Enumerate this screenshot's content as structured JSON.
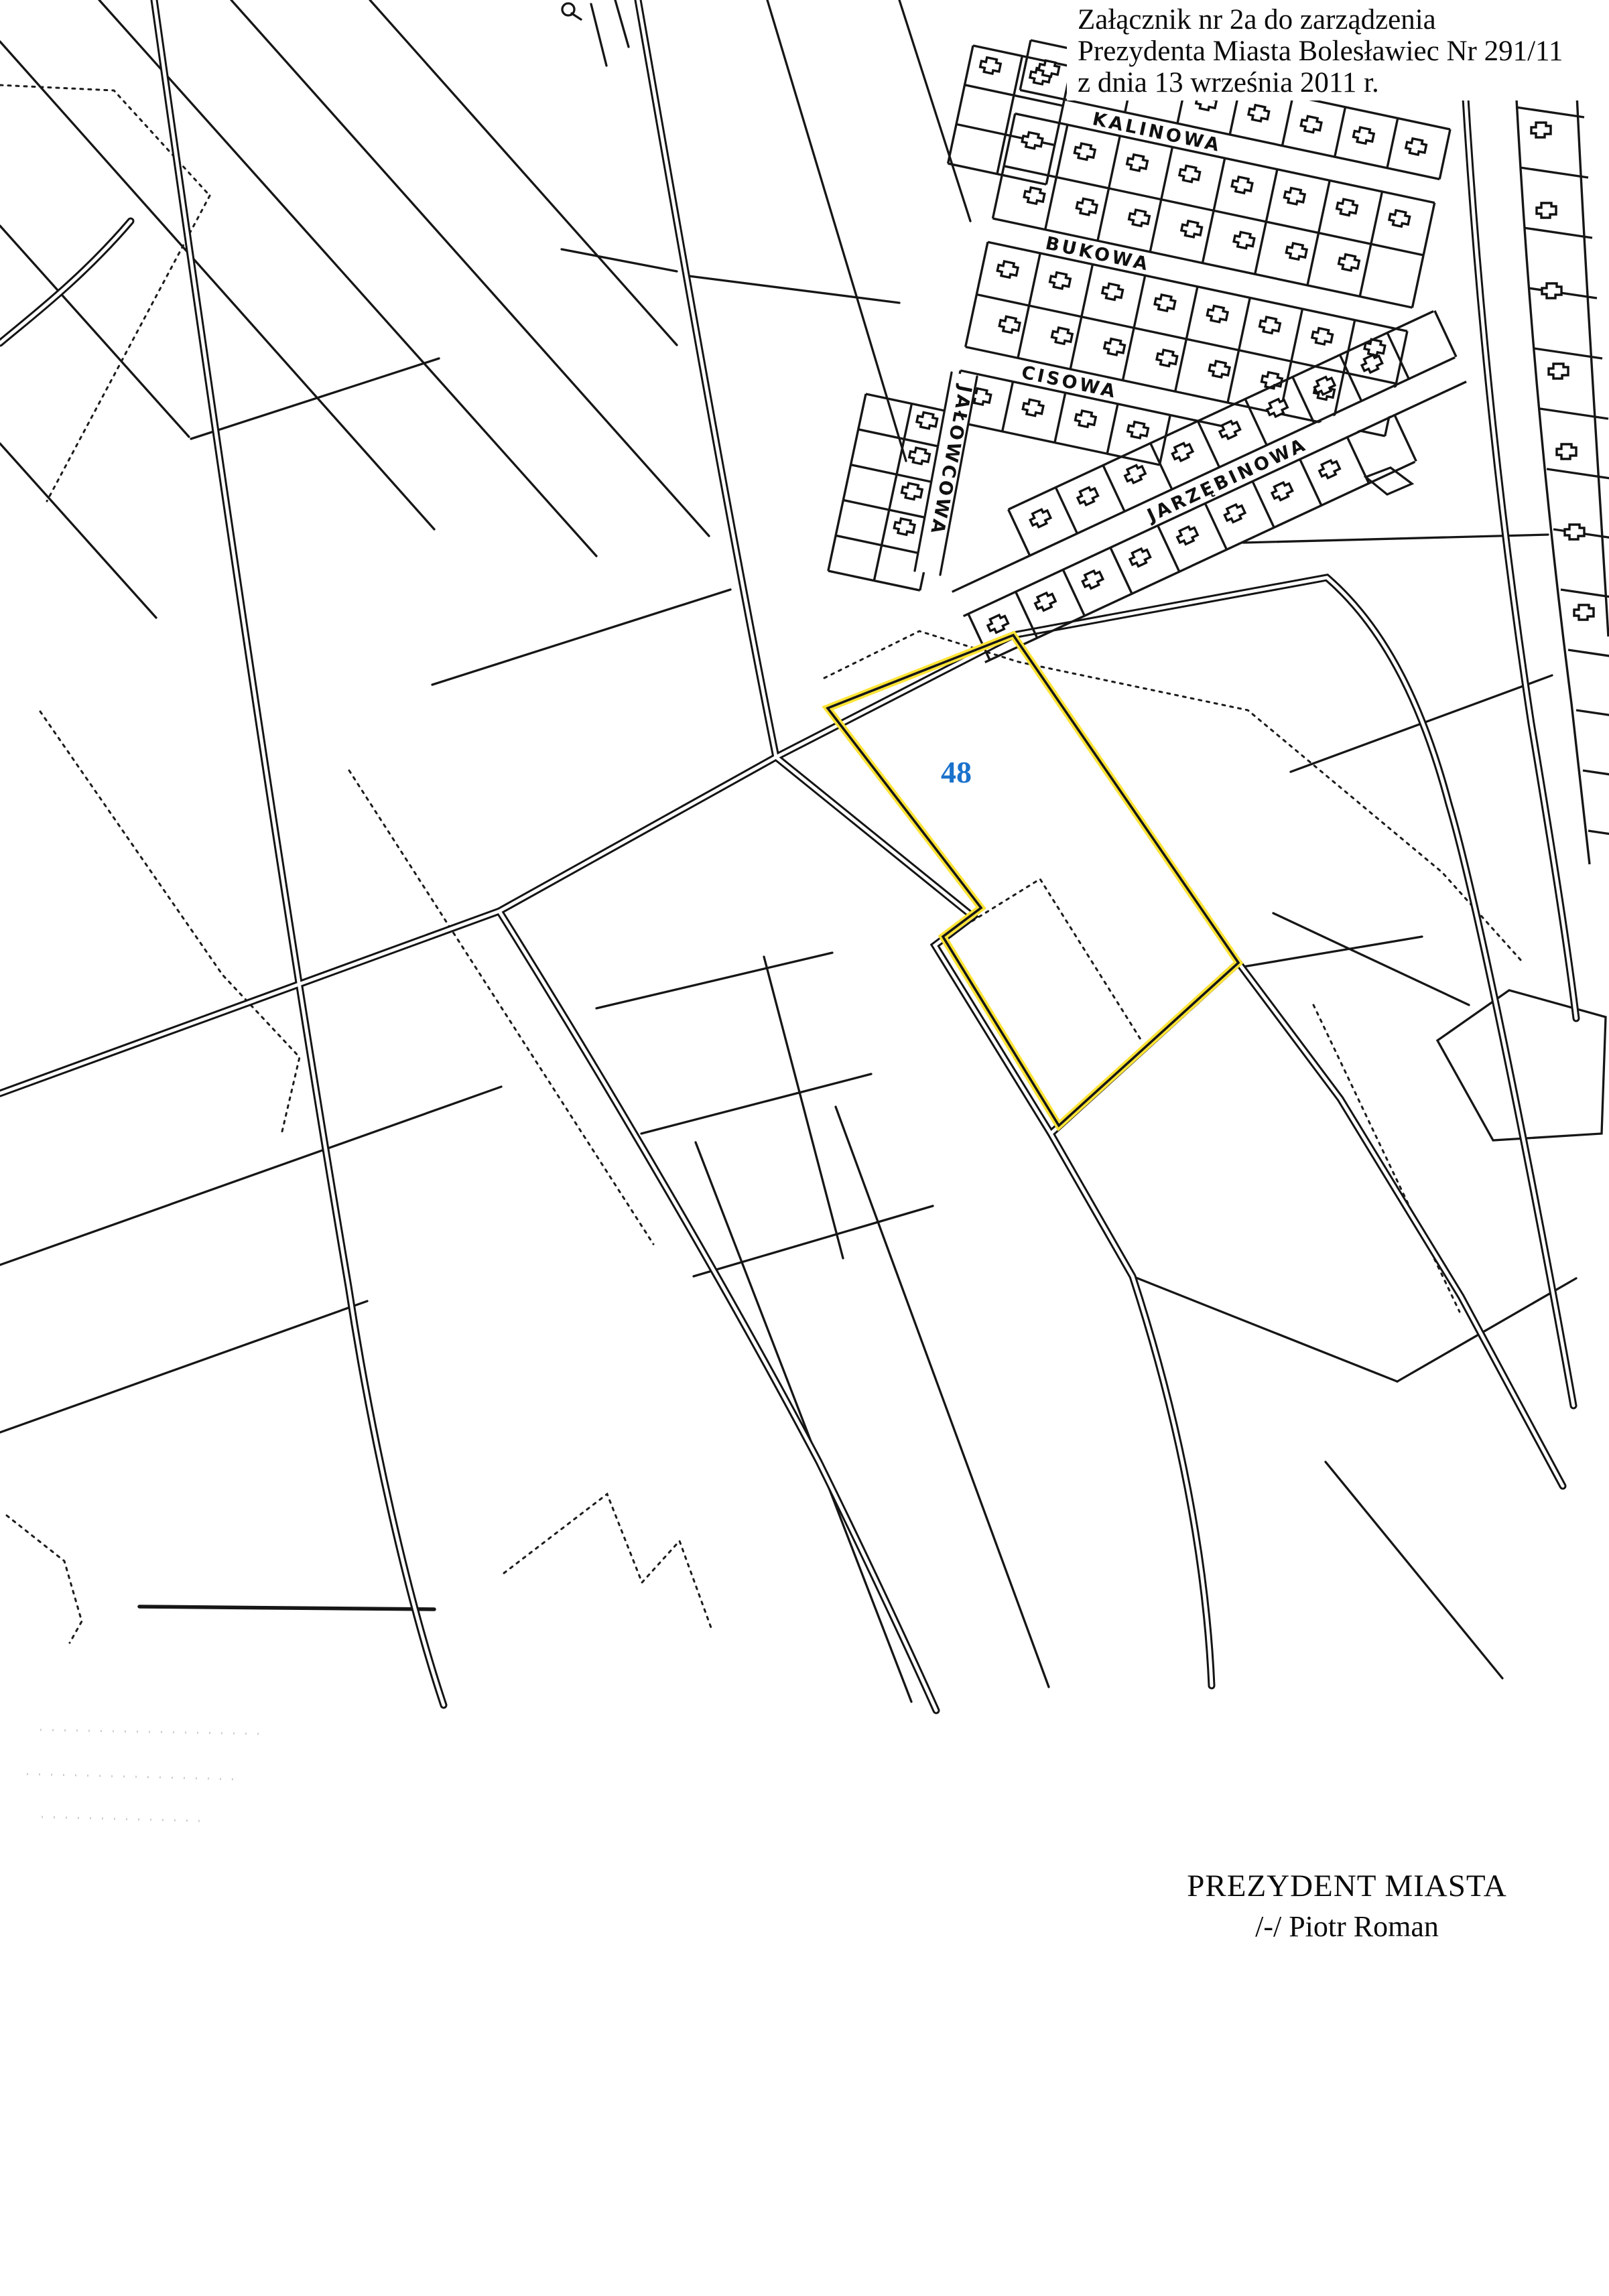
{
  "annotation": {
    "line1": "Załącznik nr 2a do zarządzenia",
    "line2": "Prezydenta Miasta Bolesławiec Nr 291/11",
    "line3": "z dnia 13 września 2011 r."
  },
  "highlighted_parcel": {
    "number": "48",
    "number_color": "#1b72cc",
    "outline_color": "#ffe437"
  },
  "street_labels": {
    "kalinowa": "KALINOWA",
    "bukowa": "BUKOWA",
    "cisowa": "CISOWA",
    "jalowcowa": "JAŁOWCOWA",
    "jarzebinowa": "JARZĘBINOWA"
  },
  "signature": {
    "title": "PREZYDENT MIASTA",
    "name": "/-/  Piotr Roman"
  }
}
